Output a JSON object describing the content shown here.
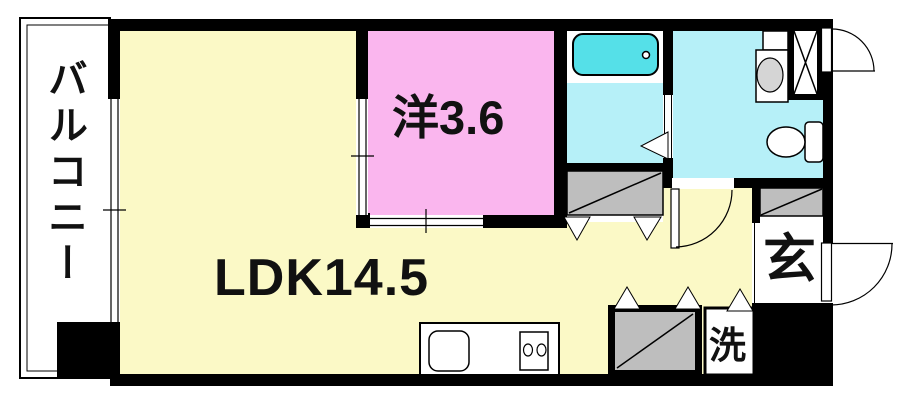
{
  "plan_title": "apartment-floor-plan",
  "rooms": {
    "balcony": {
      "label": "バルコニー"
    },
    "ldk": {
      "label": "LDK14.5"
    },
    "western": {
      "label": "洋3.6"
    },
    "entrance": {
      "label": "玄"
    },
    "laundry": {
      "label": "洗"
    }
  },
  "colors": {
    "wall": "#000000",
    "ldk_floor": "#FBF9C6",
    "western_floor": "#FAB6EE",
    "wet_floor": "#B6F0F8",
    "bathtub": "#55E0E8",
    "closet": "#BEBEBE",
    "sink_bowl": "#D5D5D5",
    "fixture": "#FFFFFF",
    "outline": "#000000"
  }
}
